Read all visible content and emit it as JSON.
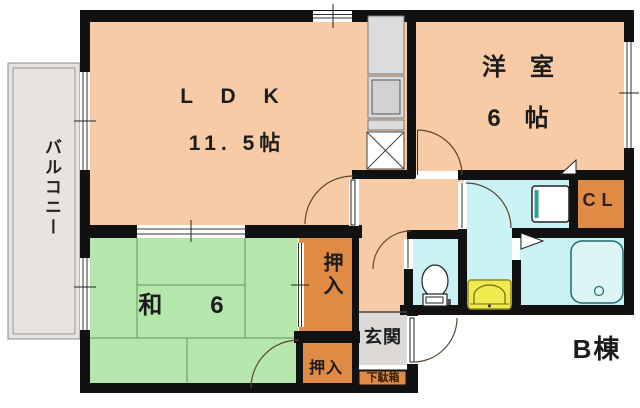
{
  "rooms": {
    "balcony": {
      "label": "バルコニー"
    },
    "ldk": {
      "label": "L D K",
      "size": "11. 5帖"
    },
    "western_room": {
      "label": "洋　室",
      "size": "6　帖"
    },
    "japanese_room": {
      "label": "和　6"
    },
    "closet_upper": {
      "label": "押入"
    },
    "closet_lower": {
      "label": "押入"
    },
    "closet_cl": {
      "label": "CL"
    },
    "entrance": {
      "label": "玄関"
    },
    "shoe_cabinet": {
      "label": "下駄箱"
    }
  },
  "annotation": {
    "building_label": "B棟"
  },
  "colors": {
    "wall_black": "#111111",
    "room_salmon": "#f7cba6",
    "tatami_green": "#b5e7ad",
    "closet_orange": "#df8a45",
    "wet_cyan": "#c9f3f4",
    "entry_gray": "#dbd8d6",
    "balcony_gray": "#e7e3e1",
    "tatami_line": "#5f9659",
    "door_arc": "#5a4632",
    "basin_yellow": "#f1ea4e",
    "washer_teal": "#27a39b",
    "tub_fill": "#dcf6f6",
    "tub_stroke": "#1f6b6b"
  }
}
